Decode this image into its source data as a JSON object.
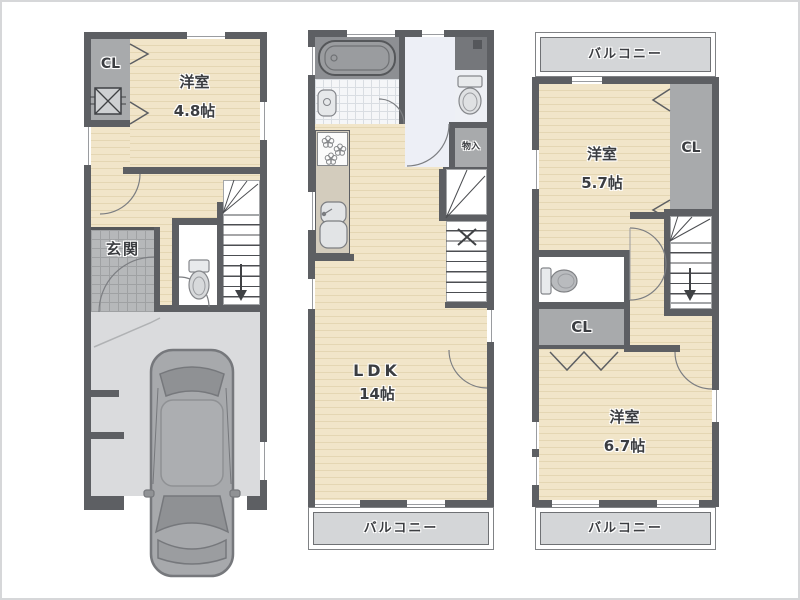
{
  "title": "3-story house floor plan",
  "colors": {
    "wall": "#5d5f63",
    "floor_beige": "#f1e5c9",
    "floor_stripe": "#e4d6b3",
    "closet_gray": "#a8aaac",
    "entrance_tile": "#b6b8ba",
    "garage_floor": "#dadbdd",
    "hallway": "#edeff6",
    "bath_floor": "#8d8f93",
    "balcony_fill": "#d4d6d8",
    "text": "#3b3d41"
  },
  "floor1": {
    "closet": "CL",
    "room": "洋室",
    "room_size": "4.8帖",
    "entrance": "玄関"
  },
  "floor2": {
    "storage": "物入",
    "ldk": "LDK",
    "ldk_size": "14帖",
    "balcony": "バルコニー"
  },
  "floor3": {
    "balcony_top": "バルコニー",
    "room_top": "洋室",
    "room_top_size": "5.7帖",
    "closet_right": "CL",
    "closet_mid": "CL",
    "room_bottom": "洋室",
    "room_bottom_size": "6.7帖",
    "balcony_bottom": "バルコニー"
  }
}
